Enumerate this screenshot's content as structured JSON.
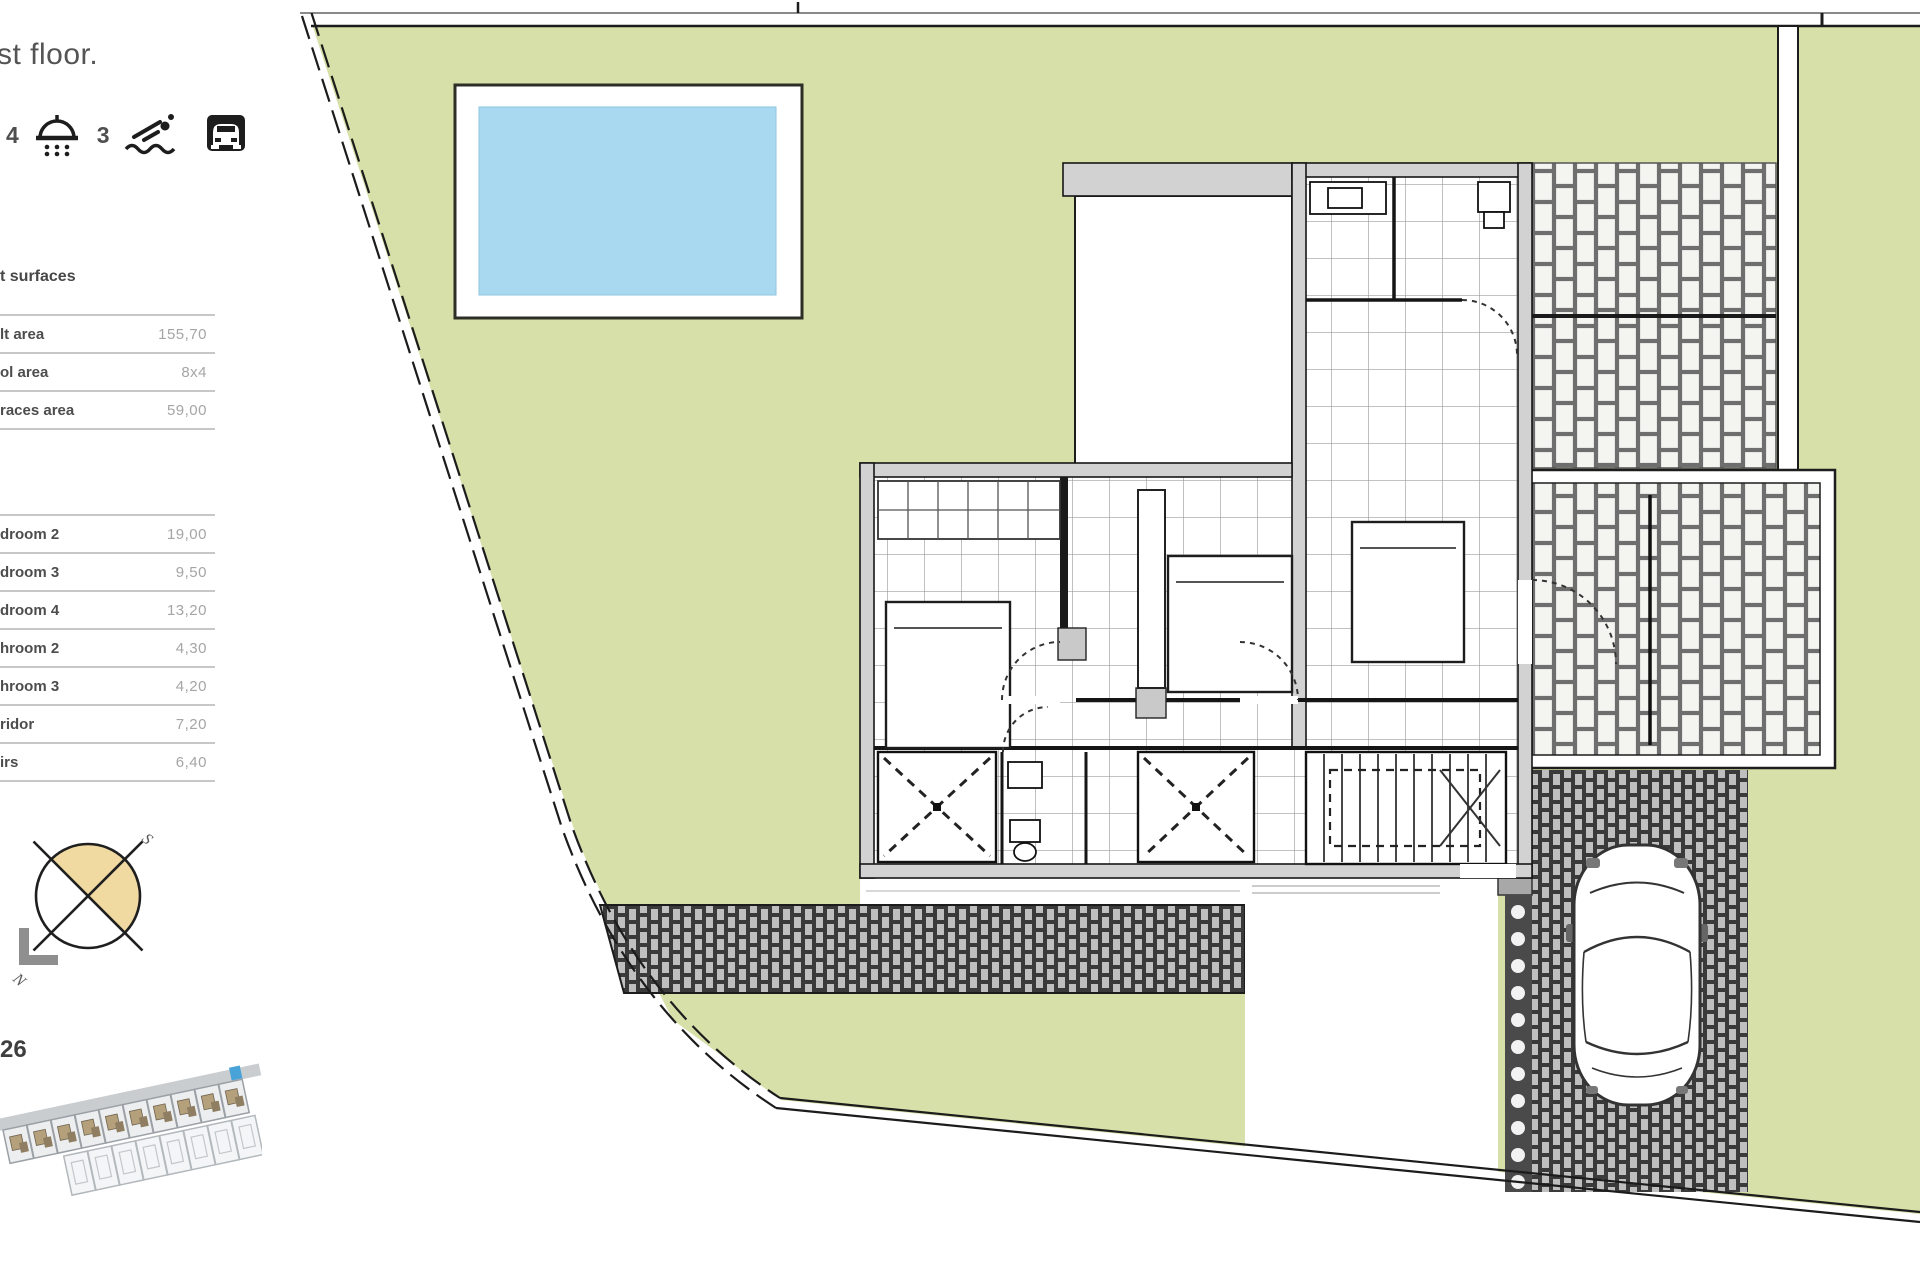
{
  "page": {
    "title_fragment": "st floor."
  },
  "amenities": {
    "count_a": "4",
    "count_b": "3",
    "icons": [
      "shower-icon",
      "swimmer-icon",
      "garage-icon"
    ]
  },
  "surfaces": {
    "heading_fragment": "t surfaces",
    "general": [
      {
        "label": "lt area",
        "value": "155,70"
      },
      {
        "label": "ol area",
        "value": "8x4"
      },
      {
        "label": "races area",
        "value": "59,00"
      }
    ],
    "rooms": [
      {
        "label": "droom 2",
        "value": "19,00"
      },
      {
        "label": "droom 3",
        "value": "9,50"
      },
      {
        "label": "droom 4",
        "value": "13,20"
      },
      {
        "label": "hroom 2",
        "value": "4,30"
      },
      {
        "label": "hroom 3",
        "value": "4,20"
      },
      {
        "label": "ridor",
        "value": "7,20"
      },
      {
        "label": "irs",
        "value": "6,40"
      }
    ]
  },
  "compass": {
    "north": "N",
    "south": "S",
    "fill": "#f1d9a2"
  },
  "locator": {
    "lot_number": "26",
    "highlight_color": "#4aa3d8"
  },
  "plan": {
    "garden_color": "#d7e0a9",
    "pool_color": "#a8d9f0",
    "wall_color": "#d2d2d2",
    "paving_dark": "#3a3a3a",
    "brick_joint": "#6e6e6e"
  }
}
